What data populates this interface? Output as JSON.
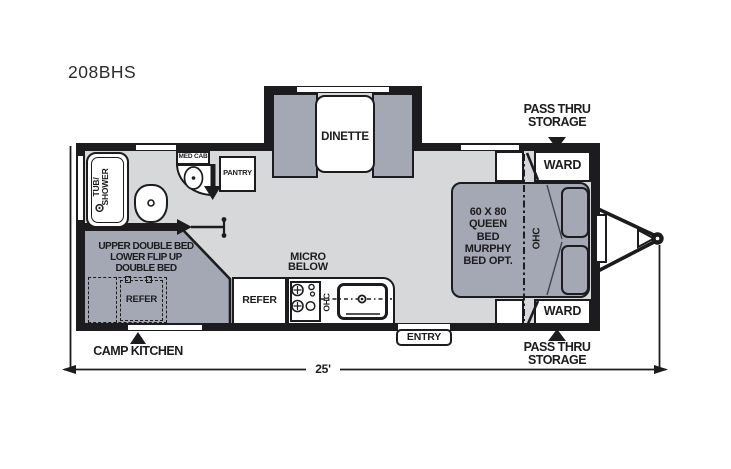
{
  "model": "208BHS",
  "colors": {
    "wall": "#1c1c1e",
    "floor": "#d7d8da",
    "furniture": "#a3a8b4",
    "background": "#ffffff"
  },
  "dimension": {
    "length": "25'"
  },
  "exterior": {
    "pass_thru_top": {
      "line1": "PASS THRU",
      "line2": "STORAGE"
    },
    "pass_thru_bottom": {
      "line1": "PASS THRU",
      "line2": "STORAGE"
    },
    "camp_kitchen": "CAMP KITCHEN",
    "entry": "ENTRY"
  },
  "rooms": {
    "dinette": {
      "label": "DINETTE"
    },
    "bathroom": {
      "tub_line1": "TUB/",
      "tub_line2": "SHOWER",
      "med_cab": "MED CAB",
      "pantry": "PANTRY"
    },
    "bedroom": {
      "bed_lines": [
        "60 X 80",
        "QUEEN",
        "BED",
        "MURPHY",
        "BED OPT."
      ],
      "ohc": "OHC",
      "ward_top": "WARD",
      "ward_bottom": "WARD"
    },
    "bunk": {
      "lines": [
        "UPPER DOUBLE BED",
        "LOWER FLIP UP",
        "DOUBLE BED"
      ],
      "refer_dashed": "REFER"
    },
    "kitchen": {
      "refer": "REFER",
      "micro_line1": "MICRO",
      "micro_line2": "BELOW",
      "ohc": "OHC"
    }
  }
}
